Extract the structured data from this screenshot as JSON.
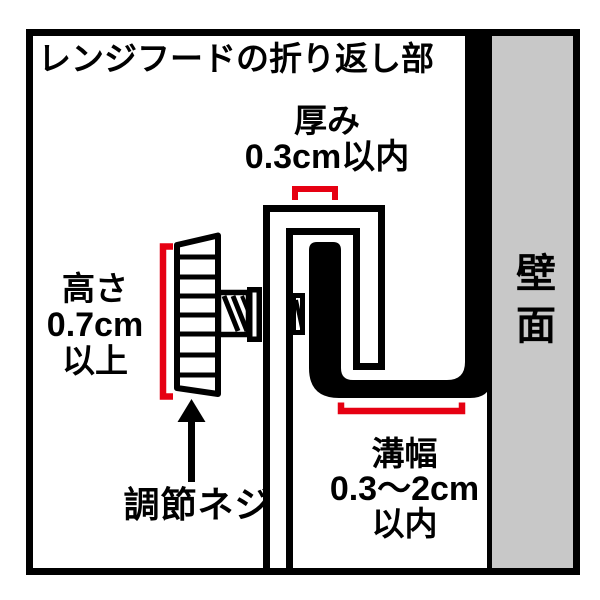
{
  "title": "レンジフードの折り返し部",
  "annotations": {
    "thickness": {
      "label": "厚み",
      "value": "0.3cm以内"
    },
    "height": {
      "label": "高さ",
      "value": "0.7cm",
      "qualifier": "以上"
    },
    "groove_width": {
      "label": "溝幅",
      "value": "0.3〜2cm",
      "qualifier": "以内"
    },
    "adjustment_screw": {
      "label": "調節ネジ"
    },
    "wall": {
      "label": "壁面"
    }
  },
  "colors": {
    "line_black": "#000000",
    "dimension_red": "#e60012",
    "wall_gray": "#c8c8c8",
    "background": "#ffffff"
  }
}
